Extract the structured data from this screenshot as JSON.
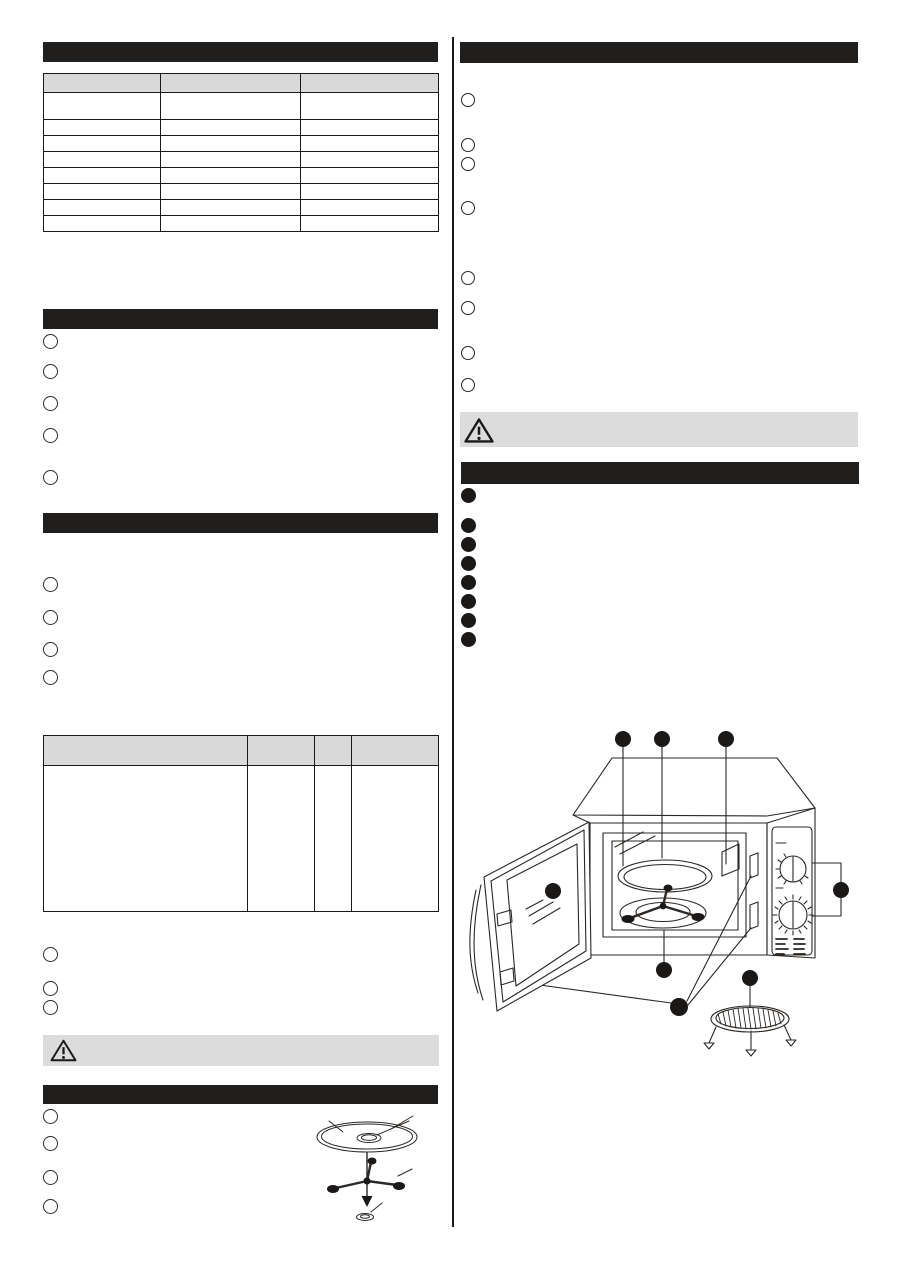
{
  "colors": {
    "ink": "#1b1918",
    "section_bar": "#211e1e",
    "table_header": "#d9d9d9",
    "warning_band": "#dcdcdc",
    "page_background": "#ffffff"
  },
  "left": {
    "bar1_label": "",
    "table1": {
      "headers": [
        "",
        "",
        ""
      ],
      "rows": [
        [
          "",
          "",
          ""
        ],
        [
          "",
          "",
          ""
        ],
        [
          "",
          "",
          ""
        ],
        [
          "",
          "",
          ""
        ],
        [
          "",
          "",
          ""
        ],
        [
          "",
          "",
          ""
        ],
        [
          "",
          "",
          ""
        ],
        [
          "",
          "",
          ""
        ]
      ]
    },
    "bar2_label": "",
    "list1": [
      "",
      "",
      "",
      "",
      ""
    ],
    "bar3_label": "",
    "list2": [
      "",
      "",
      "",
      ""
    ],
    "table2": {
      "headers": [
        "",
        "",
        "",
        ""
      ],
      "rows": [
        [
          "",
          "",
          "",
          ""
        ]
      ]
    },
    "list3": [
      "",
      "",
      ""
    ],
    "warning_label": "",
    "bar4_label": "",
    "list4": [
      "",
      "",
      "",
      ""
    ]
  },
  "right": {
    "bar1_label": "",
    "list1": [
      "",
      "",
      "",
      "",
      "",
      "",
      "",
      ""
    ],
    "warning_label": "",
    "bar2_label": "",
    "features": [
      "",
      "",
      "",
      "",
      "",
      "",
      "",
      ""
    ]
  },
  "figures": {
    "turntable_assembly": {
      "parts": [
        "glass-turntable-tray",
        "roller-ring",
        "turntable-coupler"
      ],
      "down_arrow": true,
      "leader_lines": 4
    },
    "oven_overview": {
      "parts": [
        "open-door",
        "door-window",
        "oven-cavity",
        "glass-tray",
        "roller-ring",
        "door-latch-slots",
        "control-panel",
        "power-knob",
        "timer-knob",
        "grill-rack"
      ],
      "callout_markers": 8
    }
  },
  "icons": {
    "warning_triangle": "alert-exclamation-triangle"
  }
}
